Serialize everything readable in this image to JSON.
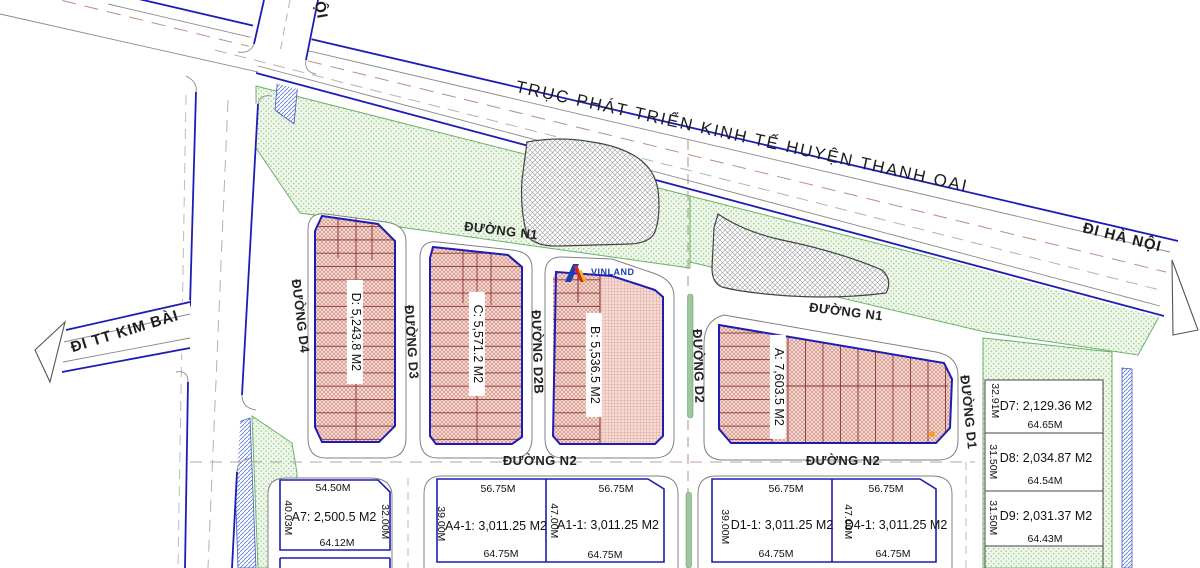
{
  "map": {
    "highway_label": "TRỤC PHÁT TRIỂN KINH TẾ HUYỆN THANH OAI",
    "direction_labels": {
      "hanoi": "ĐI HÀ NỘI",
      "kimbai": "ĐI TT KIM BÀI",
      "top_partial": "ỘI"
    },
    "road_labels": {
      "n1_left": "ĐƯỜNG N1",
      "n1_right": "ĐƯỜNG N1",
      "n2_left": "ĐƯỜNG N2",
      "n2_right": "ĐƯỜNG N2",
      "d4": "ĐƯỜNG D4",
      "d3": "ĐƯỜNG D3",
      "d2b": "ĐƯỜNG D2B",
      "d2": "ĐƯỜNG D2",
      "d1": "ĐƯỜNG D1"
    },
    "zones": [
      {
        "id": "D",
        "label": "D: 5,243.8 M2"
      },
      {
        "id": "C",
        "label": "C: 5,571.2 M2"
      },
      {
        "id": "B",
        "label": "B: 5,536.5 M2"
      },
      {
        "id": "A",
        "label": "A: 7,603.5 M2"
      }
    ],
    "bottom_plots": [
      {
        "id": "A7",
        "area": "A7: 2,500.5 M2",
        "top": "54.50M",
        "bottom": "64.12M",
        "left": "40.03M",
        "right": "32.00M"
      },
      {
        "id": "A4-1",
        "area": "A4-1: 3,011.25 M2",
        "top": "56.75M",
        "bottom": "64.75M",
        "left": "39.00M"
      },
      {
        "id": "A1-1",
        "area": "A1-1: 3,011.25 M2",
        "top": "56.75M",
        "bottom": "64.75M",
        "left": "47.00M"
      },
      {
        "id": "D1-1",
        "area": "D1-1: 3,011.25 M2",
        "top": "56.75M",
        "bottom": "64.75M",
        "left": "39.00M"
      },
      {
        "id": "D4-1",
        "area": "D4-1: 3,011.25 M2",
        "top": "56.75M",
        "bottom": "64.75M",
        "left": "47.00M"
      }
    ],
    "right_plots": [
      {
        "id": "D7",
        "area": "D7: 2,129.36 M2",
        "width": "64.65M",
        "side": "32.91M"
      },
      {
        "id": "D8",
        "area": "D8: 2,034.87 M2",
        "width": "64.54M",
        "side": "31.50M"
      },
      {
        "id": "D9",
        "area": "D9: 2,031.37 M2",
        "width": "64.43M",
        "side": "31.50M"
      }
    ],
    "logo": "VINLAND",
    "colors": {
      "plot_border": "#1d1db5",
      "plot_hatch": "#cf8374",
      "green_border": "#6cb26c",
      "highway_blue": "#1d1db5",
      "marker_orange": "#f59a23"
    }
  }
}
